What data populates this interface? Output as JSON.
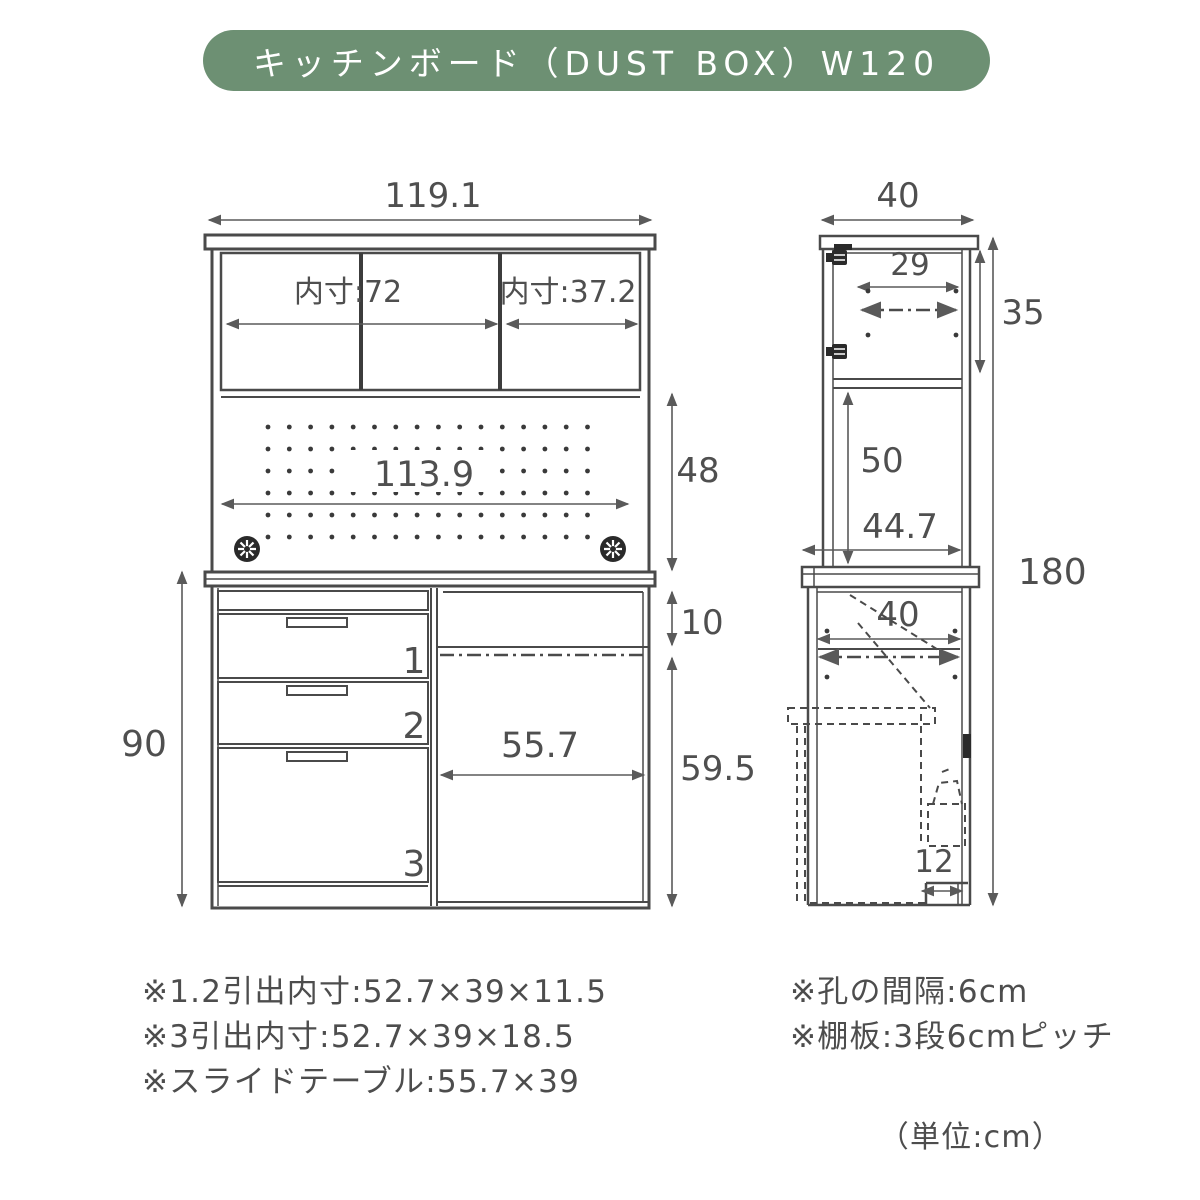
{
  "title": "キッチンボード（DUST BOX）W120",
  "colors": {
    "banner_green": "#6d9073",
    "line": "#4a4a4a",
    "text": "#4f4f4f"
  },
  "front": {
    "dims": {
      "total_width": "119.1",
      "inner_left": "内寸:72",
      "inner_right": "内寸:37.2",
      "board_width": "113.9",
      "open_height": "48",
      "counter_gap": "10",
      "lower_height": "90",
      "slide_width": "55.7",
      "lower_right_height": "59.5"
    },
    "drawers": [
      "1",
      "2",
      "3"
    ]
  },
  "side": {
    "dims": {
      "depth": "40",
      "upper_inner_width": "29",
      "upper_inner_height": "35",
      "open_height": "50",
      "counter_depth": "44.7",
      "total_height": "180",
      "lower_depth": "40",
      "base_depth": "12"
    }
  },
  "notes": {
    "left": [
      "※1.2引出内寸:52.7×39×11.5",
      "※3引出内寸:52.7×39×18.5",
      "※スライドテーブル:55.7×39"
    ],
    "right": [
      "※孔の間隔:6cm",
      "※棚板:3段6cmピッチ"
    ],
    "unit": "（単位:cm）"
  }
}
